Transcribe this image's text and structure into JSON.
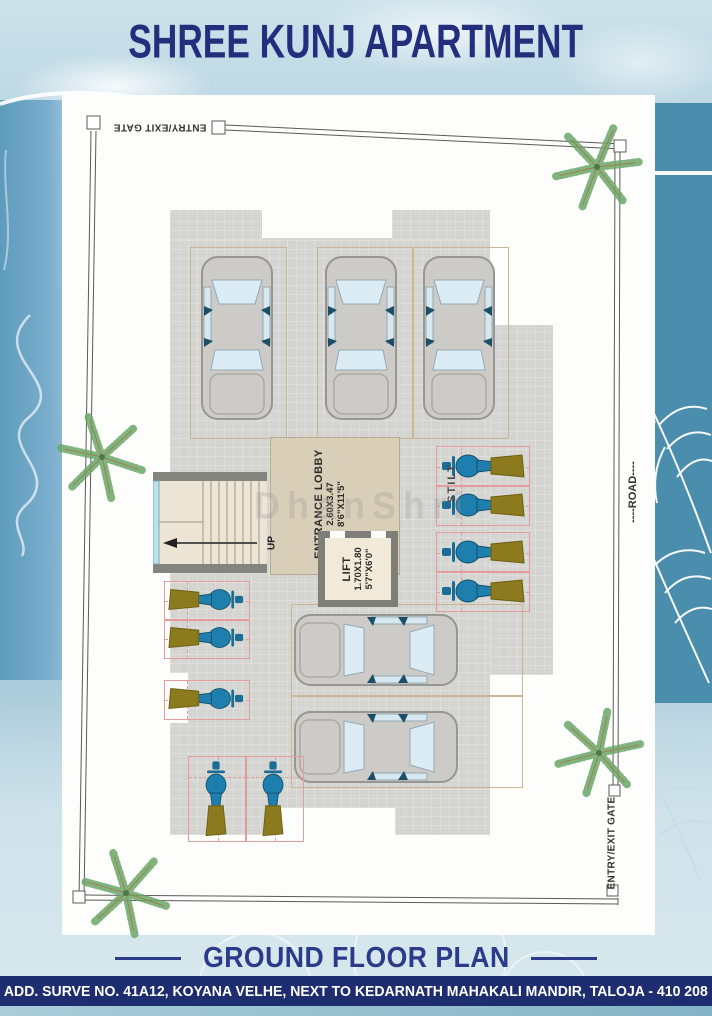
{
  "header": {
    "title": "SHREE KUNJ APARTMENT"
  },
  "plan": {
    "watermark": "DhanShri",
    "labels": {
      "gate_top": "ENTRY/EXIT GATE",
      "gate_right": "ENTRY/EXIT GATE",
      "road": "----ROAD----",
      "stilt": "STILT",
      "up": "UP",
      "lobby_title": "ENTRANCE LOBBY",
      "lobby_dim_m": "2.60X3.47",
      "lobby_dim_ft": "8'6\"X11'5\"",
      "lift_title": "LIFT",
      "lift_dim_m": "1.70X1.80",
      "lift_dim_ft": "5'7\"X6'0\""
    }
  },
  "footer": {
    "heading": "GROUND FLOOR PLAN",
    "address": "ADD. SURVE NO. 41A12, KOYANA VELHE, NEXT TO KEDARNATH MAHAKALI MANDIR, TALOJA - 410 208"
  },
  "colors": {
    "accent_navy": "#232e7d",
    "footer_navy": "#1e2c70",
    "slab_gray": "#d4d4d1",
    "lobby_tan": "#d9ceb7",
    "scooter_blue": "#1e7fae",
    "scooter_seat_olive": "#8b7a1e",
    "car_window_blue": "#dcecf4",
    "teal_panel": "#4a8dad"
  }
}
